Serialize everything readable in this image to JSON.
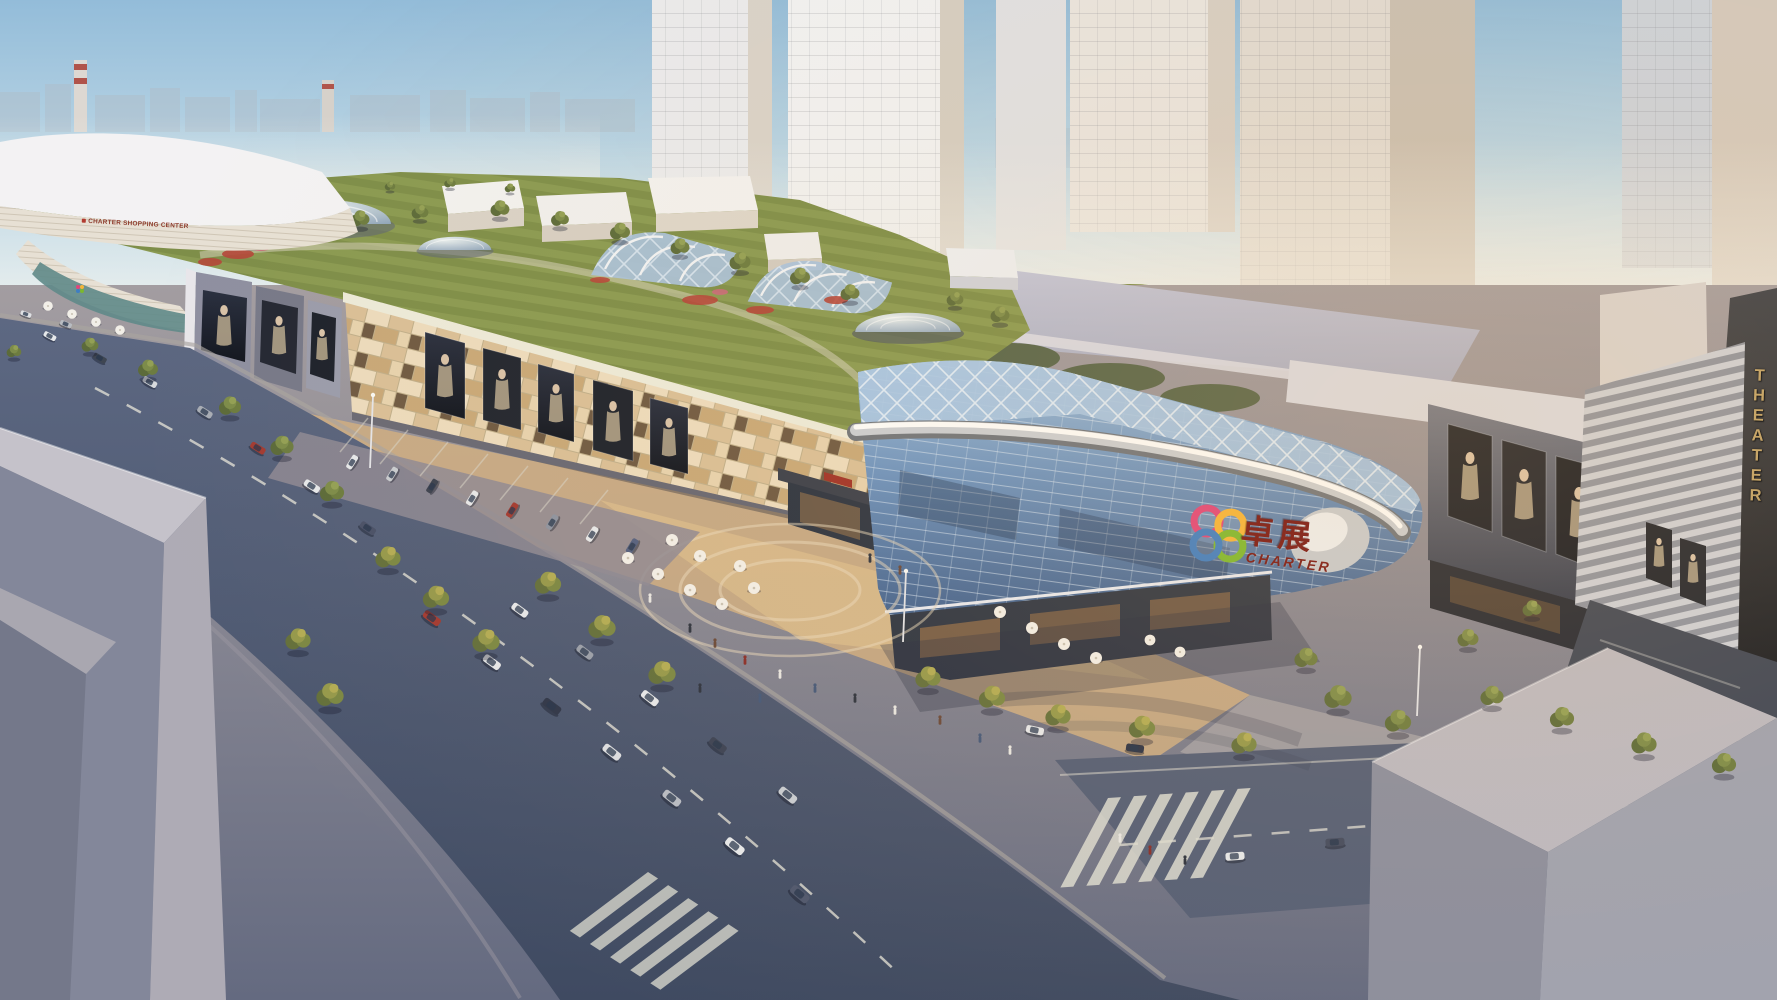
{
  "scene": {
    "kind": "architectural-aerial-rendering",
    "subject": "Charter shopping mall complex — aerial rendering with rooftop garden, glass atrium, street plaza and theater wing",
    "lighting": "warm late-afternoon light from the right"
  },
  "signs": {
    "roof_fascia_label": "CHARTER SHOPPING CENTER",
    "glass_logo_cn": "卓展",
    "glass_logo_en": "CHARTER",
    "theater_sign": "THEATER"
  },
  "logo": {
    "name": "charter-quatrefoil",
    "ring_colors": [
      "#e0457b",
      "#f5b53a",
      "#7cb82f",
      "#3f7ec2"
    ]
  },
  "colors": {
    "sky_top": "#93bcd9",
    "sky_horizon": "#f3f1ea",
    "facade_beige": "#d9bf97",
    "facade_dark_tile": "#6f5a43",
    "glass_blue": "#6b92bf",
    "chrome_band": "#d8dde2",
    "roof_garden_green": "#7e8e49",
    "road_asphalt": "#4a5570",
    "plaza_warm": "#cfae82",
    "logo_text_red": "#8a2d20",
    "fascia_text_red": "#8e3b2c",
    "theater_gold": "#c8a668",
    "tree_green": "#6d7c40",
    "foreground_building_grey": "#9a9cab"
  }
}
